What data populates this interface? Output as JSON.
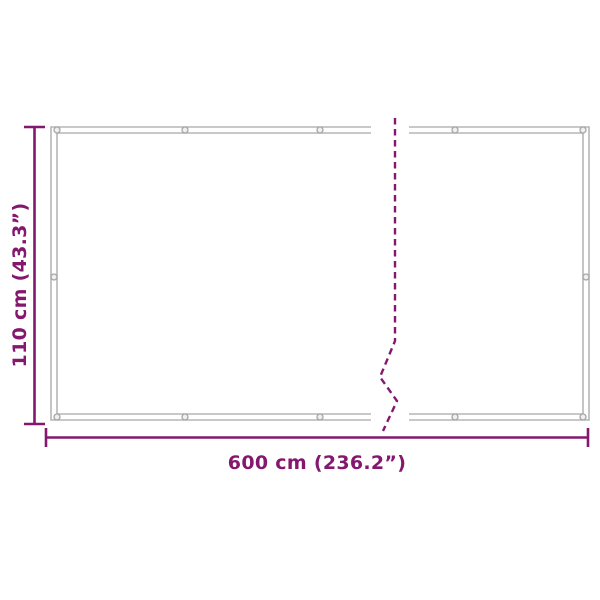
{
  "diagram": {
    "type": "product-dimension-diagram",
    "width_label": "600 cm (236.2”)",
    "height_label": "110 cm (43.3”)"
  },
  "colors": {
    "dimension": "#84186F",
    "frame": "#B5B5B5",
    "grommet": "#A6A6A6",
    "background": "#FFFFFF"
  }
}
